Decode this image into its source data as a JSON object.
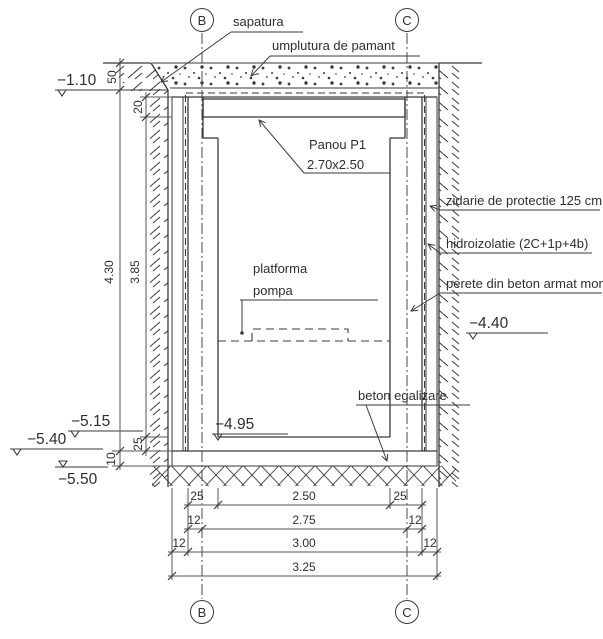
{
  "drawing": {
    "title_none": "",
    "axes": {
      "b": "B",
      "c": "C"
    },
    "labels": {
      "sapatura": "sapatura",
      "umplutura": "umplutura de pamant",
      "panou_name": "Panou P1",
      "panou_size": "2.70x2.50",
      "zidarie": "zidarie de protectie 125 cm",
      "hidroizolatie": "hidroizolatie (2C+1p+4b)",
      "perete": "perete din beton armat monolit",
      "platforma_l1": "platforma",
      "platforma_l2": "pompa",
      "beton_egalizare": "beton egalizare"
    },
    "elevations": {
      "wall_top": "−1.10",
      "ground_right": "−4.40",
      "floor": "−4.95",
      "left_1": "−5.15",
      "left_2": "−5.40",
      "left_3": "−5.50"
    },
    "dims_vertical": {
      "fill": "50",
      "panou": "20",
      "wall_total": "4.30",
      "interior": "3.85",
      "radier": "25",
      "egalizare": "10"
    },
    "dims_bottom": {
      "row1": [
        "25",
        "2.50",
        "25"
      ],
      "row2": [
        "12",
        "2.75",
        "12"
      ],
      "row3": [
        "12",
        "3.00",
        "12"
      ],
      "total": "3.25"
    },
    "colors": {
      "line": "#3a3a3a",
      "background": "#ffffff"
    }
  }
}
